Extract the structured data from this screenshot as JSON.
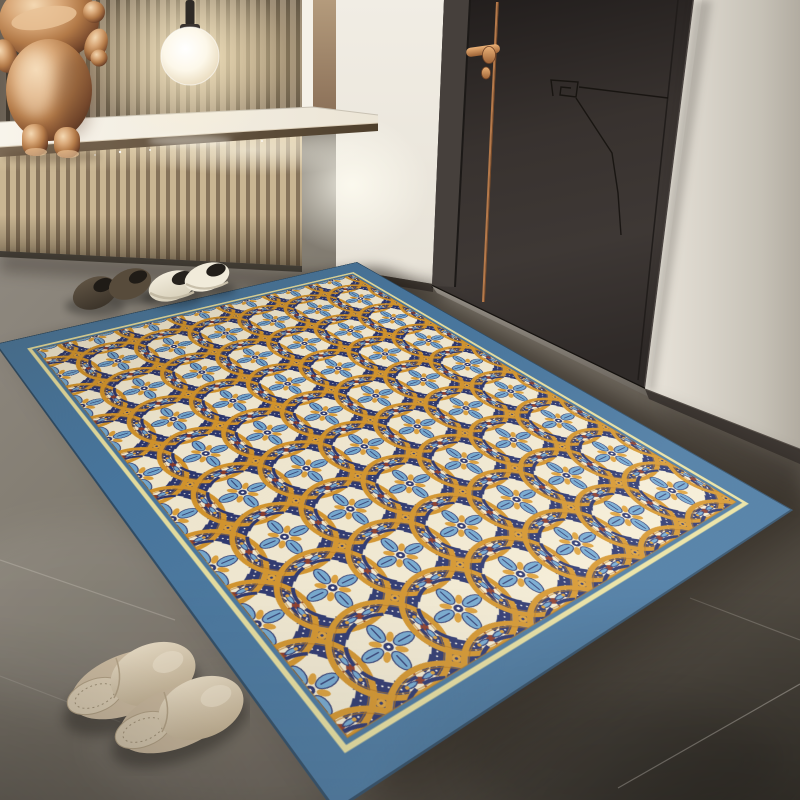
{
  "scene": {
    "type": "product-photo",
    "description": "Entryway scene: a Moroccan-style medallion area rug with a steel-blue border lies on a dark grey tile floor in front of a charcoal door with copper handle and trim line. At the left is a wood slat accent wall with a white console shelf lit from below, a glowing globe pendant lamp and a copper bear figurine. Two pairs of shoes sit by the wall and a pair of beige slippers rests beside the rug.",
    "objects": [
      {
        "id": "area-rug",
        "label": "Moroccan medallion area rug with steel-blue border"
      },
      {
        "id": "entry-door",
        "label": "Charcoal entry door with copper handle and inlay line"
      },
      {
        "id": "slat-wall",
        "label": "Wood slat accent wall"
      },
      {
        "id": "console-shelf",
        "label": "White floating console shelf with LED underlight"
      },
      {
        "id": "pendant-lamp",
        "label": "Glowing white globe pendant lamp"
      },
      {
        "id": "bear-figurine",
        "label": "Copper metallic bear figurine"
      },
      {
        "id": "shoes-brown-pair",
        "label": "Dark brown suede slip-on shoes"
      },
      {
        "id": "shoes-cream-pair",
        "label": "Cream slip-on sneakers with black collar"
      },
      {
        "id": "slippers-pair",
        "label": "Beige closed-toe slippers"
      },
      {
        "id": "tile-floor",
        "label": "Dark grey concrete-look tile floor"
      }
    ]
  },
  "rug": {
    "style": "Moroccan tile pattern: interlocking amber circles, navy diamond medallions with white dots, light-blue floral motifs, maroon accents on cream ground",
    "border_color": "#4878a2",
    "inner_trim_color": "#eae2a2",
    "field_color": "#f5edd6"
  },
  "palette": {
    "rug-border": "#4878a2",
    "rug-trim": "#eae2a2",
    "rug-cream": "#f5edd6",
    "rug-navy": "#2a3570",
    "rug-amber": "#d6962c",
    "rug-blue": "#74aad3",
    "rug-gold": "#dfa23b",
    "rug-maroon": "#8e3b2a",
    "door": "#37322e",
    "copper": "#c08a5c",
    "wall-left": "#f2eee5",
    "wall-right": "#d9d4ca",
    "floor-dark": "#4a453d",
    "floor-light": "#938d82",
    "counter": "#f4efe6"
  }
}
